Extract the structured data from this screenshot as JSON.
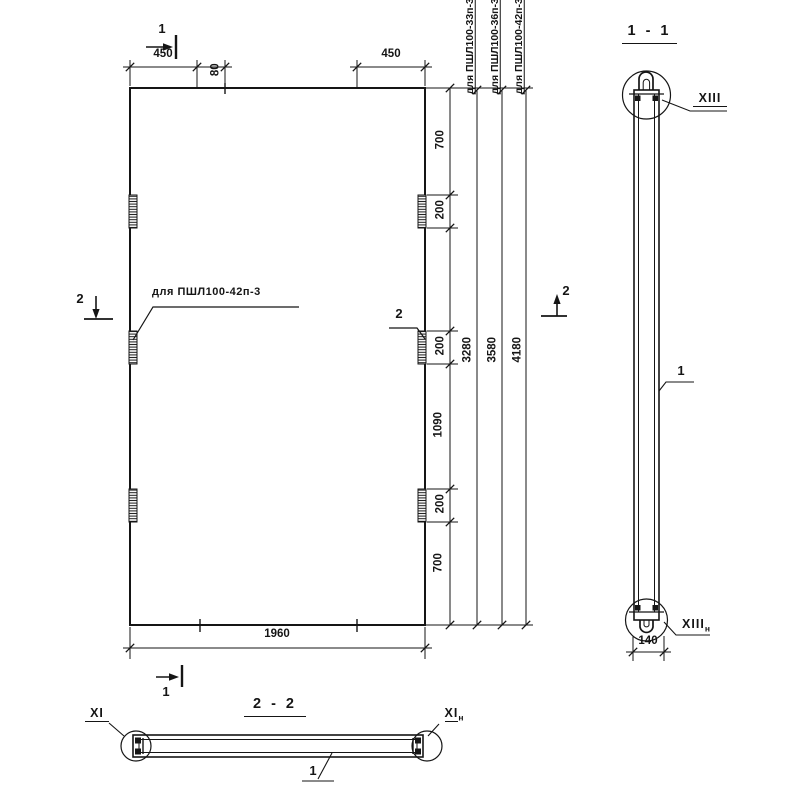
{
  "plan": {
    "dim_450_left": "450",
    "dim_80": "80",
    "dim_450_right": "450",
    "dim_1960": "1960",
    "chain": {
      "c700_top": "700",
      "c200_top": "200",
      "c200_mid": "200",
      "c1090": "1090",
      "c200_bot": "200",
      "c700_bot": "700"
    },
    "overall": {
      "len_33": "3280",
      "len_36": "3580",
      "len_42": "4180"
    },
    "variant_labels": {
      "v33": "для ПШЛ100-33п-3",
      "v36": "для ПШЛ100-36п-3",
      "v42": "для ПШЛ100-42п-3"
    },
    "callout_variant": "для ПШЛ100-42п-3",
    "callout_2": "2",
    "section1_mark": "1",
    "section2_mark": "2"
  },
  "section_1_1": {
    "title": "1 - 1",
    "detail_top": "XIII",
    "detail_bottom": "XIII",
    "detail_bottom_sub": "н",
    "dim_140": "140",
    "ref": "1"
  },
  "section_2_2": {
    "title": "2 - 2",
    "detail_left": "XI",
    "detail_right": "XI",
    "detail_right_sub": "н",
    "ref": "1"
  },
  "colors": {
    "ink": "#151515",
    "paper": "#ffffff"
  }
}
